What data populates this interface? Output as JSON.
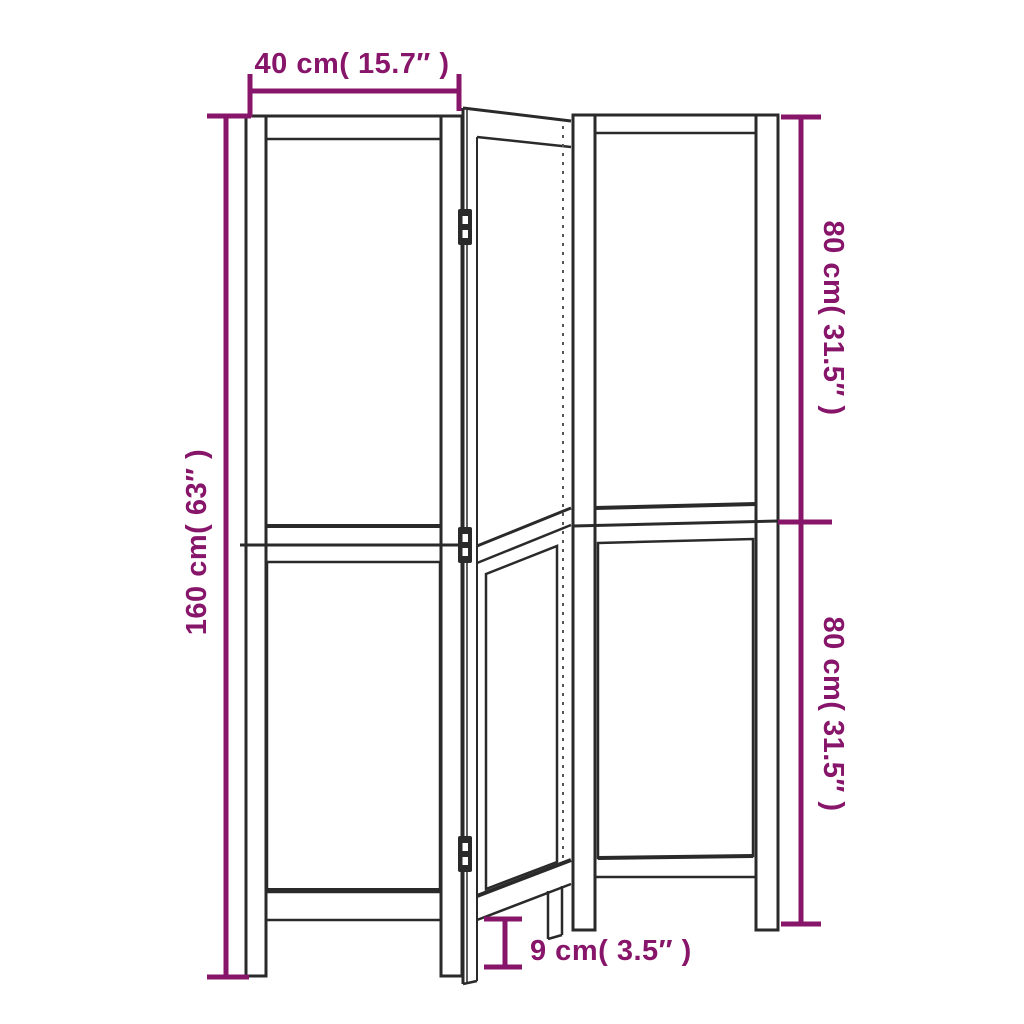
{
  "colors": {
    "dimension_color": "#871569",
    "line_color": "#2a2a2a",
    "hidden_line_color": "#555555",
    "background_color": "#ffffff"
  },
  "labels": {
    "panel_width": "40 cm( 15.7″ )",
    "total_height": "160 cm( 63″ )",
    "upper_section_height": "80 cm( 31.5″ )",
    "lower_section_height": "80 cm( 31.5″ )",
    "ground_clearance": "9 cm( 3.5″ )"
  },
  "measurements": {
    "panel_width_cm": 40,
    "panel_width_in": 15.7,
    "total_height_cm": 160,
    "total_height_in": 63,
    "upper_section_cm": 80,
    "upper_section_in": 31.5,
    "lower_section_cm": 80,
    "lower_section_in": 31.5,
    "ground_clearance_cm": 9,
    "ground_clearance_in": 3.5
  }
}
